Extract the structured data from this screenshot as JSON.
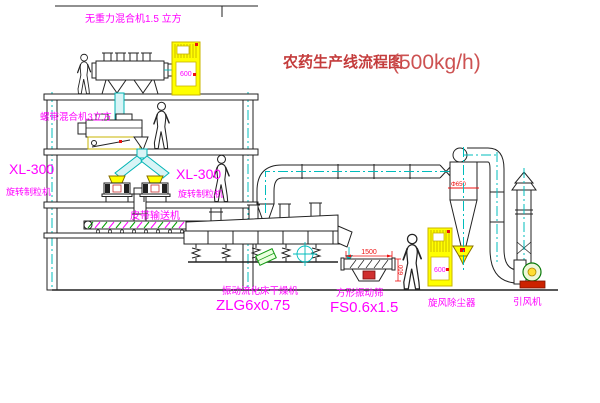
{
  "title": {
    "main": "农药生产线流程图",
    "capacity": "(500kg/h)"
  },
  "labels": {
    "mixer_top": "无重力混合机1.5 立方",
    "mixer_floor2": "螺带混合机3立方",
    "granulator_left_model": "XL-300",
    "granulator_left_name": "旋转制粒机",
    "granulator_right_model": "XL-300",
    "granulator_right_name": "旋转制粒机",
    "belt_conveyor": "皮带输送机",
    "dryer_name": "振动流化床干燥机",
    "dryer_model": "ZLG6x0.75",
    "screen_name": "方形振动筛",
    "screen_model": "FS0.6x1.5",
    "cyclone_name": "旋风除尘器",
    "fan_name": "引风机"
  },
  "dimensions": {
    "screen_length": "1500",
    "screen_width": "600",
    "cyclone_flange": "Φ650"
  },
  "cabinets": {
    "panel_text": "600"
  },
  "colors": {
    "label_magenta": "#ff00ff",
    "title_red": "#c43c3c",
    "dimension_red": "#ee1111",
    "centerline_cyan": "#00bcbc",
    "cabinet_yellow": "#ffff00",
    "line_black": "#222222"
  }
}
